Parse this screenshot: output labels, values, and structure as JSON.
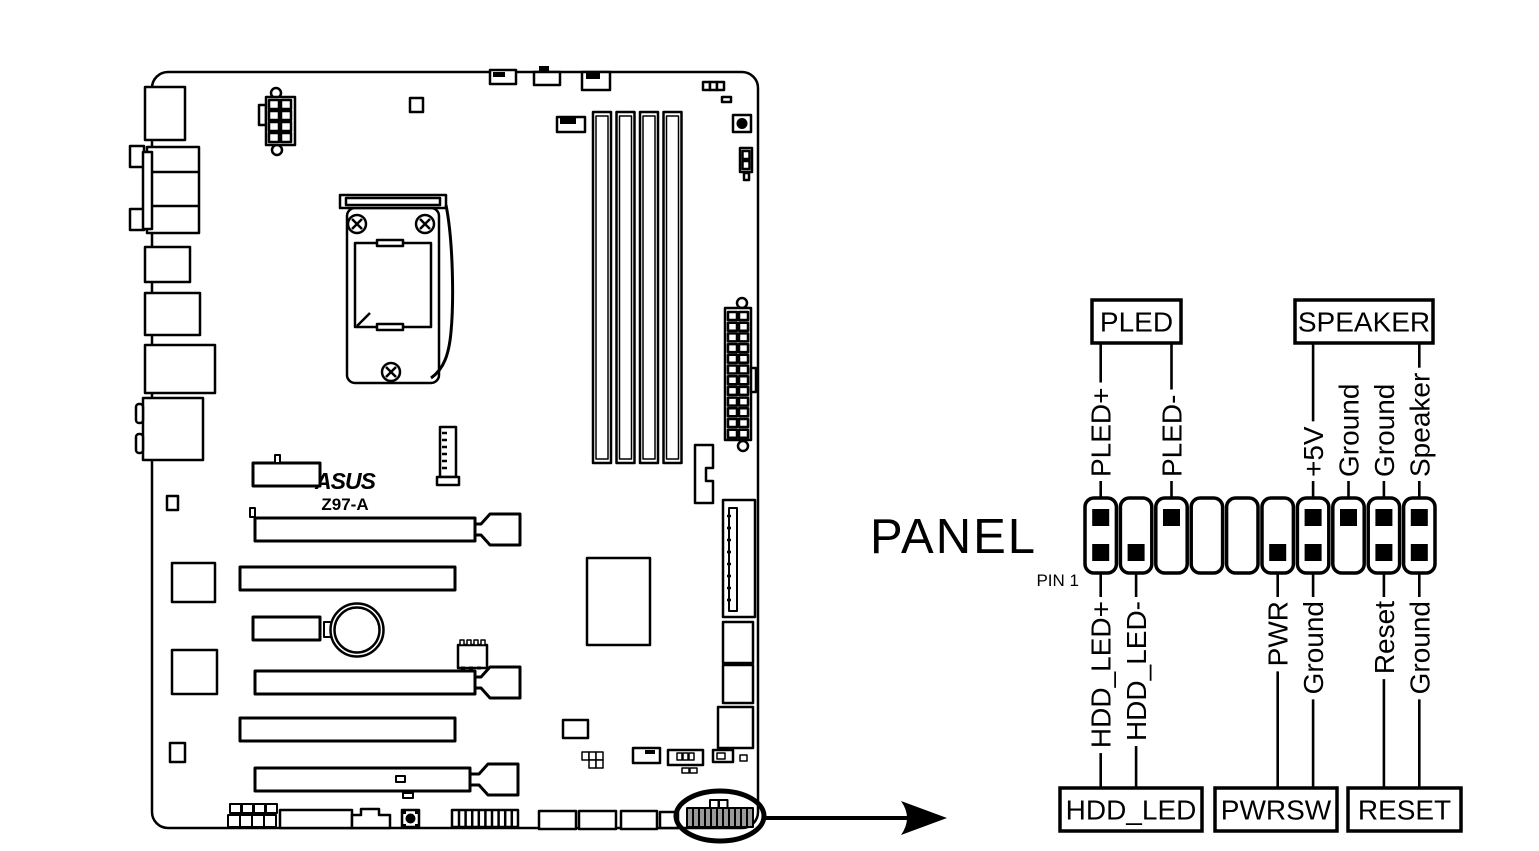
{
  "board": {
    "brand": "ASUS",
    "model": "Z97-A"
  },
  "connector": {
    "panel_label": "PANEL",
    "pin1_label": "PIN 1",
    "columns": [
      {
        "top": "PLED+",
        "bottom": "HDD_LED+"
      },
      {
        "top": null,
        "bottom": "HDD_LED-"
      },
      {
        "top": "PLED-",
        "bottom": null
      },
      {
        "top": null,
        "bottom": null
      },
      {
        "top": null,
        "bottom": null
      },
      {
        "top": null,
        "bottom": "PWR"
      },
      {
        "top": "+5V",
        "bottom": "Ground"
      },
      {
        "top": "Ground",
        "bottom": null
      },
      {
        "top": "Ground",
        "bottom": "Reset"
      },
      {
        "top": "Speaker",
        "bottom": "Ground"
      }
    ],
    "top_boxes": [
      {
        "label": "PLED",
        "cols": [
          1,
          3
        ]
      },
      {
        "label": "SPEAKER",
        "cols": [
          7,
          10
        ]
      }
    ],
    "bottom_boxes": [
      {
        "label": "HDD_LED",
        "cols": [
          1,
          2
        ]
      },
      {
        "label": "PWRSW",
        "cols": [
          6,
          7
        ]
      },
      {
        "label": "RESET",
        "cols": [
          9,
          10
        ]
      }
    ]
  },
  "colors": {
    "line": "#000000",
    "background": "#ffffff",
    "panel_header_fill": "#9a9a9a"
  }
}
